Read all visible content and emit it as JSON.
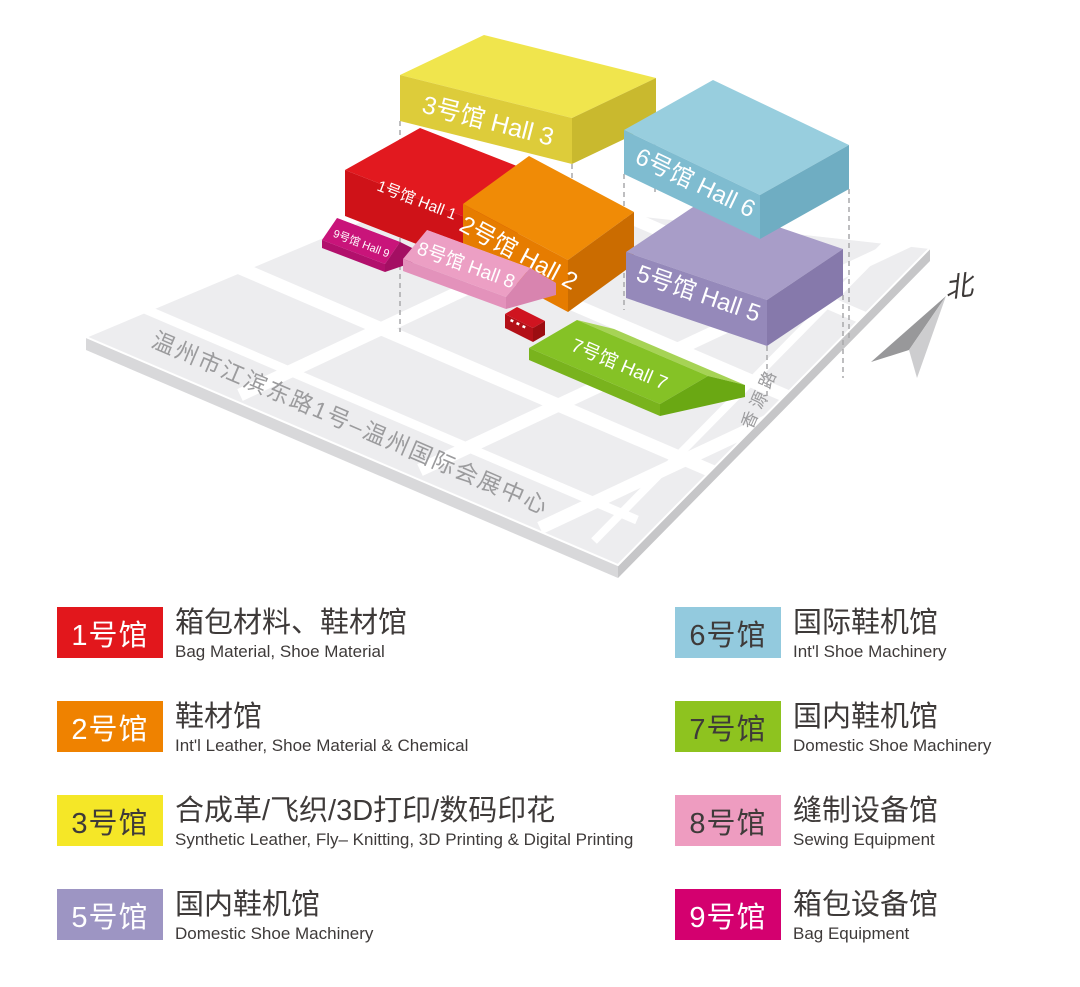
{
  "map": {
    "north_label": "北",
    "roads": {
      "main": "温州市江滨东路1号–温州国际会展中心",
      "side": "香源路"
    },
    "halls": {
      "hall1": {
        "label": "1号馆 Hall 1",
        "top": "#e2191f",
        "front": "#cf1218",
        "side": "#a90e13"
      },
      "hall2": {
        "label": "2号馆 Hall 2",
        "top": "#f08b06",
        "front": "#e67c00",
        "side": "#cb6c00"
      },
      "hall3": {
        "label": "3号馆  Hall 3",
        "top": "#f0e54d",
        "front": "#ddcc3a",
        "side": "#c9b92e"
      },
      "hall5": {
        "label": "5号馆 Hall 5",
        "top": "#a89dc8",
        "front": "#9589ba",
        "side": "#8679ab"
      },
      "hall6": {
        "label": "6号馆  Hall 6",
        "top": "#98cede",
        "front": "#7fbcd0",
        "side": "#6fadc2"
      },
      "hall7": {
        "label": "7号馆 Hall 7",
        "roof": "#85c226",
        "roof_back": "#a6d355",
        "gable": "#6aa813",
        "wall": "#79b31d"
      },
      "hall8": {
        "label": "8号馆 Hall 8",
        "roof": "#ec9fc4",
        "roof_back": "#f4bcd8",
        "gable": "#d884af",
        "wall": "#e392bb"
      },
      "hall9": {
        "label": "9号馆 Hall 9",
        "roof": "#c9147a",
        "roof_back": "#dc4f9b",
        "gable": "#a40f63",
        "wall": "#b2106c"
      }
    }
  },
  "legend": {
    "items": [
      {
        "badge": "1号馆",
        "badge_color": "#e2171c",
        "badge_text_color": "#ffffff",
        "title": "箱包材料、鞋材馆",
        "subtitle": "Bag Material, Shoe Material"
      },
      {
        "badge": "2号馆",
        "badge_color": "#ef8200",
        "badge_text_color": "#ffffff",
        "title": "鞋材馆",
        "subtitle": "Int'l Leather, Shoe Material & Chemical"
      },
      {
        "badge": "3号馆",
        "badge_color": "#f5e727",
        "badge_text_color": "#3e3a39",
        "title": "合成革/飞织/3D打印/数码印花",
        "subtitle": "Synthetic Leather, Fly– Knitting, 3D Printing & Digital Printing"
      },
      {
        "badge": "5号馆",
        "badge_color": "#9d95c3",
        "badge_text_color": "#ffffff",
        "title": "国内鞋机馆",
        "subtitle": "Domestic Shoe Machinery"
      },
      {
        "badge": "6号馆",
        "badge_color": "#93cade",
        "badge_text_color": "#3e3a39",
        "title": "国际鞋机馆",
        "subtitle": "Int'l Shoe Machinery"
      },
      {
        "badge": "7号馆",
        "badge_color": "#8ec31f",
        "badge_text_color": "#3e3a39",
        "title": "国内鞋机馆",
        "subtitle": "Domestic Shoe Machinery"
      },
      {
        "badge": "8号馆",
        "badge_color": "#ee9cc0",
        "badge_text_color": "#3e3a39",
        "title": "缝制设备馆",
        "subtitle": "Sewing Equipment"
      },
      {
        "badge": "9号馆",
        "badge_color": "#d4006f",
        "badge_text_color": "#ffffff",
        "title": "箱包设备馆",
        "subtitle": "Bag Equipment"
      }
    ]
  }
}
